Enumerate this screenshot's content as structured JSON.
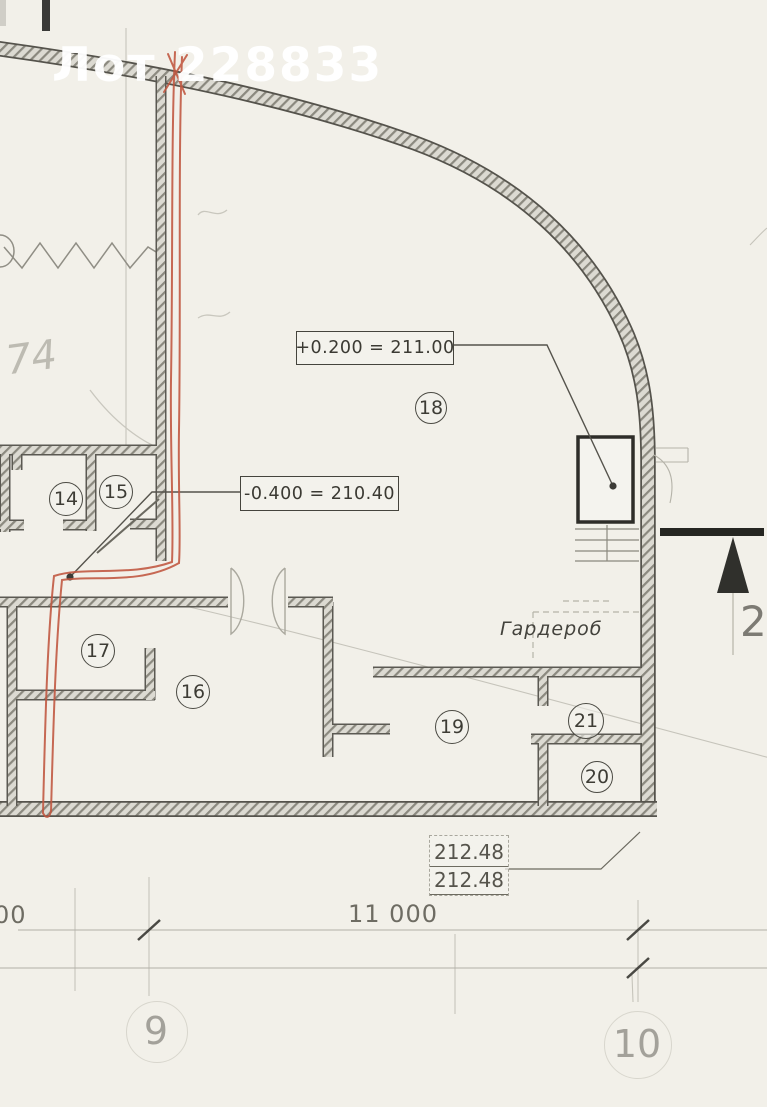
{
  "watermark": {
    "text": "Лот 228833"
  },
  "plan": {
    "elevation_labels": {
      "upper": "+0.200 = 211.00",
      "lower": "-0.400 = 210.40"
    },
    "rooms": [
      {
        "number": "14"
      },
      {
        "number": "15"
      },
      {
        "number": "16"
      },
      {
        "number": "17"
      },
      {
        "number": "18"
      },
      {
        "number": "19"
      },
      {
        "number": "20"
      },
      {
        "number": "21"
      }
    ],
    "wardrobe_label": "Гардероб",
    "handwritten_note": "74",
    "section_mark_number": "2"
  },
  "dimensions": {
    "level_values": [
      "212.48",
      "212.48"
    ],
    "overall": "11 000",
    "partial_left": "00"
  },
  "axes": [
    {
      "label": "9"
    },
    {
      "label": "10"
    }
  ],
  "colors": {
    "paper": "#f2f0e9",
    "annotation_red": "#c0563f",
    "ink": "#3d3c35"
  }
}
